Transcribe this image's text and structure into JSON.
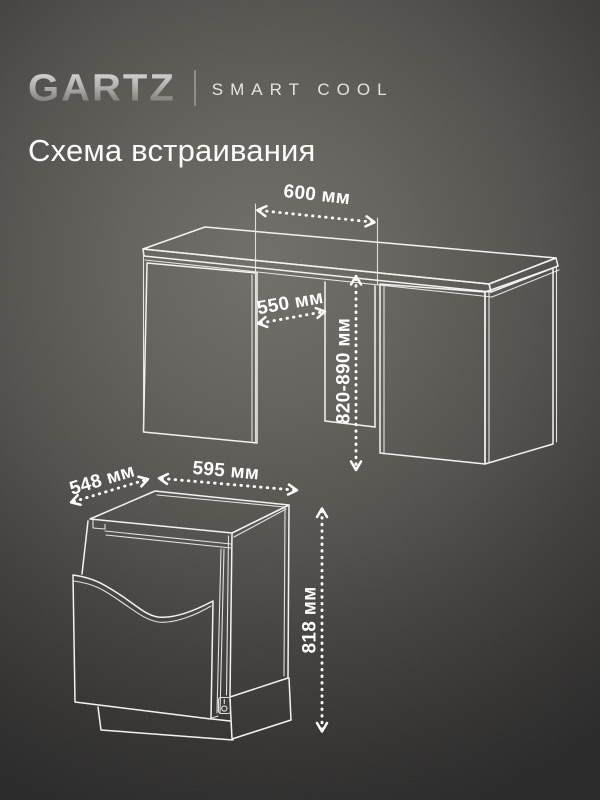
{
  "brand": {
    "logo": "GARTZ",
    "tagline": "SMART COOL"
  },
  "title": "Схема встраивания",
  "diagram": {
    "niche": {
      "width_label": "600 мм",
      "depth_label": "550 мм",
      "height_label": "820-890 мм"
    },
    "appliance": {
      "depth_label": "548 мм",
      "width_label": "595 мм",
      "height_label": "818 мм"
    }
  },
  "colors": {
    "background_center": "#6f6b66",
    "background_edge": "#252424",
    "line": "#f4f3f1",
    "text": "#ffffff",
    "logo_silver": "#b7b5b3"
  }
}
